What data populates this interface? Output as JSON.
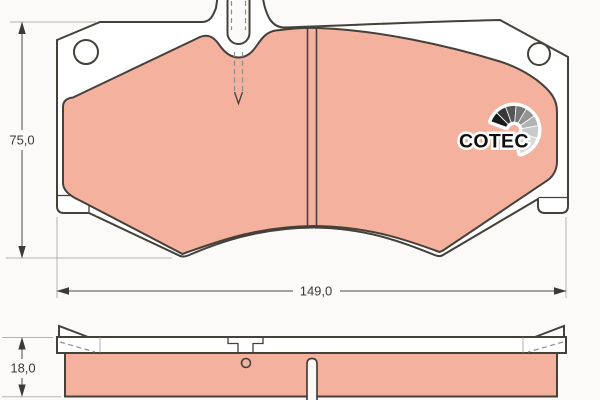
{
  "drawing": {
    "logo": {
      "text": "COTEC"
    },
    "dimensions": {
      "pad_height": "75,0",
      "pad_width": "149,0",
      "pad_thickness": "18,0"
    },
    "colors": {
      "background": "#fbfaf8",
      "friction_material": "#f4b29e",
      "backing_plate": "#ffffff",
      "outline": "#454039",
      "extension_line": "#b3b1ae",
      "dimension_text": "#3a3a3a",
      "logo_text": "#0f0f0f",
      "logo_fan": [
        "#1a1a1a",
        "#383838",
        "#555555",
        "#757575",
        "#949494",
        "#b3b3b3",
        "#c9c9c9",
        "#d9d9d9"
      ]
    }
  }
}
